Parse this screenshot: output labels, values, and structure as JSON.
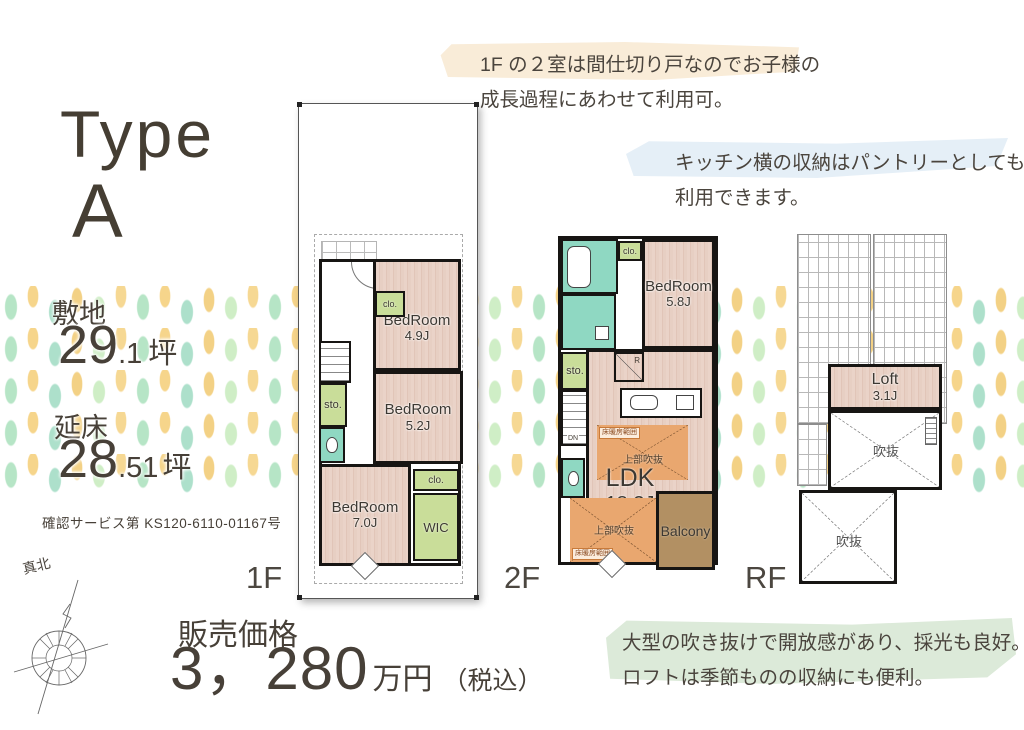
{
  "title": {
    "line1": "Type",
    "line2": "A"
  },
  "stats": {
    "site_label": "敷地",
    "site_int": "29",
    "site_frac": ".1",
    "site_unit": "坪",
    "floor_label": "延床",
    "floor_int": "28",
    "floor_frac": ".51",
    "floor_unit": "坪",
    "certification": "確認サービス第 KS120-6110-01167号"
  },
  "price": {
    "label": "販売価格",
    "amount": "3，280",
    "unit": "万円",
    "tax_note": "（税込）"
  },
  "floor_labels": {
    "f1": "1F",
    "f2": "2F",
    "rf": "RF"
  },
  "compass_label": "真北",
  "annotations": {
    "partition_line1": "1F の２室は間仕切り戸なのでお子様の",
    "partition_line2": "成長過程にあわせて利用可。",
    "pantry_line1": "キッチン横の収納はパントリーとしても",
    "pantry_line2": "利用できます。",
    "loft_line1": "大型の吹き抜けで開放感があり、採光も良好。",
    "loft_line2": "ロフトは季節ものの収納にも便利。"
  },
  "plan1f": {
    "bed1_name": "BedRoom",
    "bed1_size": "4.9J",
    "bed2_name": "BedRoom",
    "bed2_size": "5.2J",
    "bed3_name": "BedRoom",
    "bed3_size": "7.0J",
    "clo1": "clo.",
    "clo2": "clo.",
    "sto": "sto.",
    "wic": "WIC"
  },
  "plan2f": {
    "bed_name": "BedRoom",
    "bed_size": "5.8J",
    "ldk_name": "LDK",
    "ldk_size": "18.3J",
    "balcony": "Balcony",
    "clo": "clo.",
    "sto": "sto.",
    "dn": "DN",
    "fridge": "R",
    "void_upper": "上部吹抜",
    "void_lower": "上部吹抜",
    "heating_upper": "床暖房範囲",
    "heating_lower": "床暖房範囲"
  },
  "planrf": {
    "loft_name": "Loft",
    "loft_size": "3.1J",
    "void1": "吹抜",
    "void2": "吹抜"
  },
  "colors": {
    "ink": "#474038",
    "wood": "#e8d0c5",
    "green_room": "#c9dd99",
    "teal_room": "#8fd8c2",
    "void_orange": "#e9a76f",
    "balcony_brown": "#b29063",
    "highlight_peach": "#f9ecd8",
    "highlight_blue": "#e5eff7",
    "highlight_green": "#dcead9",
    "pattern_green": "#aee3c0",
    "pattern_yellow": "#f6d385"
  }
}
